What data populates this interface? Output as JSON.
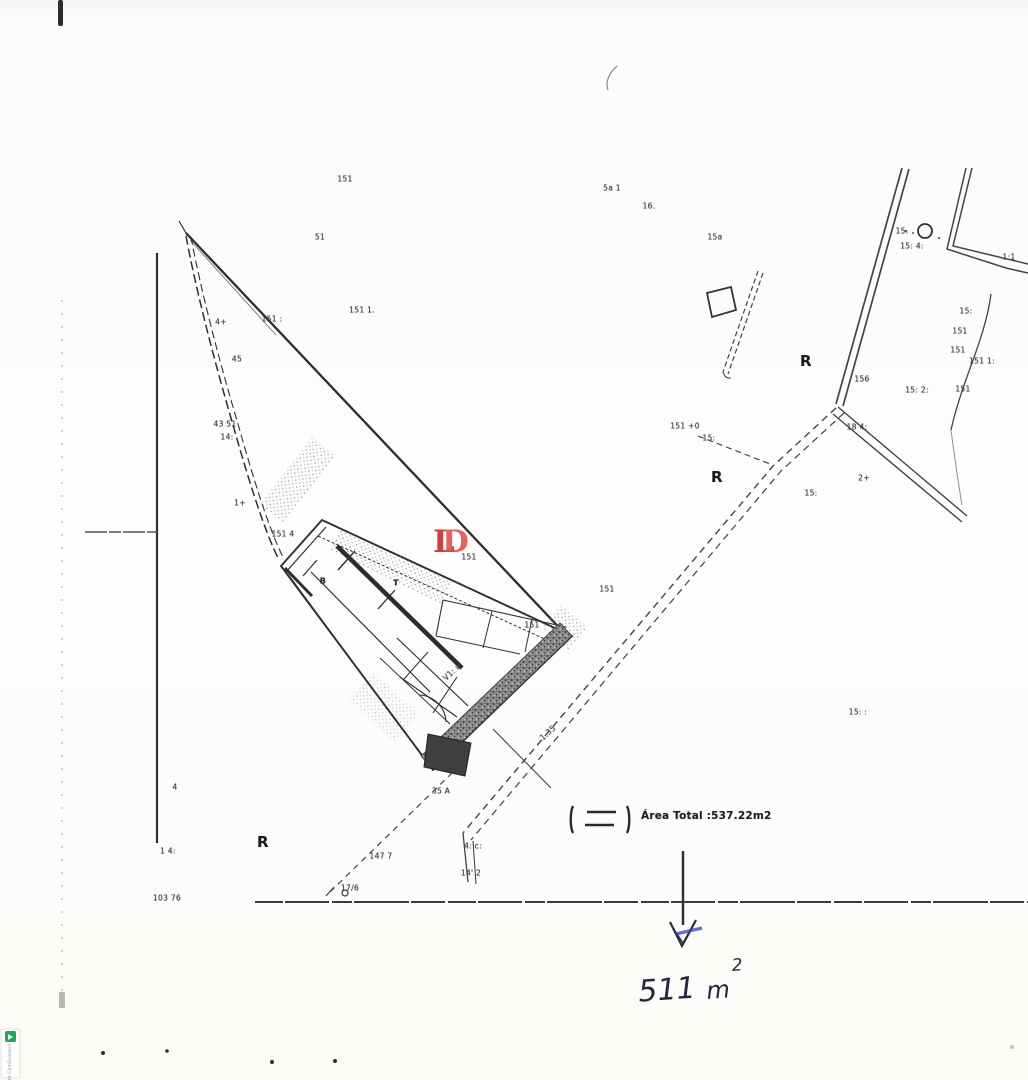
{
  "colors": {
    "paper": "#fcfcfa",
    "ink": "#2f2f2f",
    "red_stamp": "#c5302e",
    "red_stamp_light": "#dd4a41",
    "blue_ink": "#26263c",
    "blue_accent": "#3c3cc0",
    "camscanner_green": "#1ea55e"
  },
  "legend": {
    "symbol": "dashed-rect-between-brackets",
    "area_total": "Área Total :537.22m2"
  },
  "annotation": {
    "value": "511",
    "unit": "m",
    "exponent": "2",
    "arrow": "down-arrow"
  },
  "stamp": {
    "letter_back": "L",
    "letter_front": "D"
  },
  "watermark": {
    "icon": "camscanner-icon",
    "text": "Scanned with CamScanner"
  },
  "zone_letters": [
    {
      "t": "R",
      "x": 806,
      "y": 361
    },
    {
      "t": "R",
      "x": 717,
      "y": 477
    },
    {
      "t": "R",
      "x": 263,
      "y": 842
    }
  ],
  "plan_labels": [
    {
      "t": "151",
      "x": 345,
      "y": 179
    },
    {
      "t": "5a 1",
      "x": 612,
      "y": 188
    },
    {
      "t": "16.",
      "x": 649,
      "y": 206
    },
    {
      "t": "51",
      "x": 320,
      "y": 237
    },
    {
      "t": "15a",
      "x": 715,
      "y": 237
    },
    {
      "t": "15.",
      "x": 902,
      "y": 231
    },
    {
      "t": "15: 4:",
      "x": 912,
      "y": 246
    },
    {
      "t": "1:1",
      "x": 1009,
      "y": 257
    },
    {
      "t": "151 1.",
      "x": 362,
      "y": 310
    },
    {
      "t": "4+",
      "x": 221,
      "y": 322
    },
    {
      "t": "151 :",
      "x": 272,
      "y": 319
    },
    {
      "t": "45",
      "x": 237,
      "y": 359
    },
    {
      "t": "15:",
      "x": 966,
      "y": 311
    },
    {
      "t": "151",
      "x": 960,
      "y": 331
    },
    {
      "t": "151",
      "x": 958,
      "y": 350
    },
    {
      "t": "151 1:",
      "x": 982,
      "y": 361
    },
    {
      "t": "156",
      "x": 862,
      "y": 379
    },
    {
      "t": "15: 2:",
      "x": 917,
      "y": 390
    },
    {
      "t": "151",
      "x": 963,
      "y": 389
    },
    {
      "t": "43 51",
      "x": 225,
      "y": 424
    },
    {
      "t": "14:",
      "x": 227,
      "y": 437
    },
    {
      "t": "151 +0",
      "x": 685,
      "y": 426
    },
    {
      "t": "15:",
      "x": 709,
      "y": 438
    },
    {
      "t": "18 4:",
      "x": 857,
      "y": 427
    },
    {
      "t": "2+",
      "x": 864,
      "y": 478
    },
    {
      "t": "15:",
      "x": 811,
      "y": 493
    },
    {
      "t": "1+",
      "x": 240,
      "y": 503
    },
    {
      "t": "151 4",
      "x": 283,
      "y": 534
    },
    {
      "t": "151",
      "x": 469,
      "y": 557
    },
    {
      "t": "B",
      "x": 323,
      "y": 581,
      "b": 1
    },
    {
      "t": "T",
      "x": 396,
      "y": 583,
      "b": 1
    },
    {
      "t": "151",
      "x": 607,
      "y": 589
    },
    {
      "t": "151",
      "x": 532,
      "y": 625
    },
    {
      "t": "V1: a",
      "x": 452,
      "y": 672,
      "r": -44
    },
    {
      "t": "15: :",
      "x": 858,
      "y": 712
    },
    {
      "t": "1.35",
      "x": 548,
      "y": 733,
      "r": -42
    },
    {
      "t": "4",
      "x": 175,
      "y": 787
    },
    {
      "t": "35 A",
      "x": 441,
      "y": 791
    },
    {
      "t": "4: c:",
      "x": 473,
      "y": 846
    },
    {
      "t": "1 4:",
      "x": 168,
      "y": 851
    },
    {
      "t": "147 7",
      "x": 381,
      "y": 856
    },
    {
      "t": "14' 2",
      "x": 471,
      "y": 873
    },
    {
      "t": "17/6",
      "x": 350,
      "y": 888
    },
    {
      "t": "103 76",
      "x": 167,
      "y": 898
    }
  ]
}
